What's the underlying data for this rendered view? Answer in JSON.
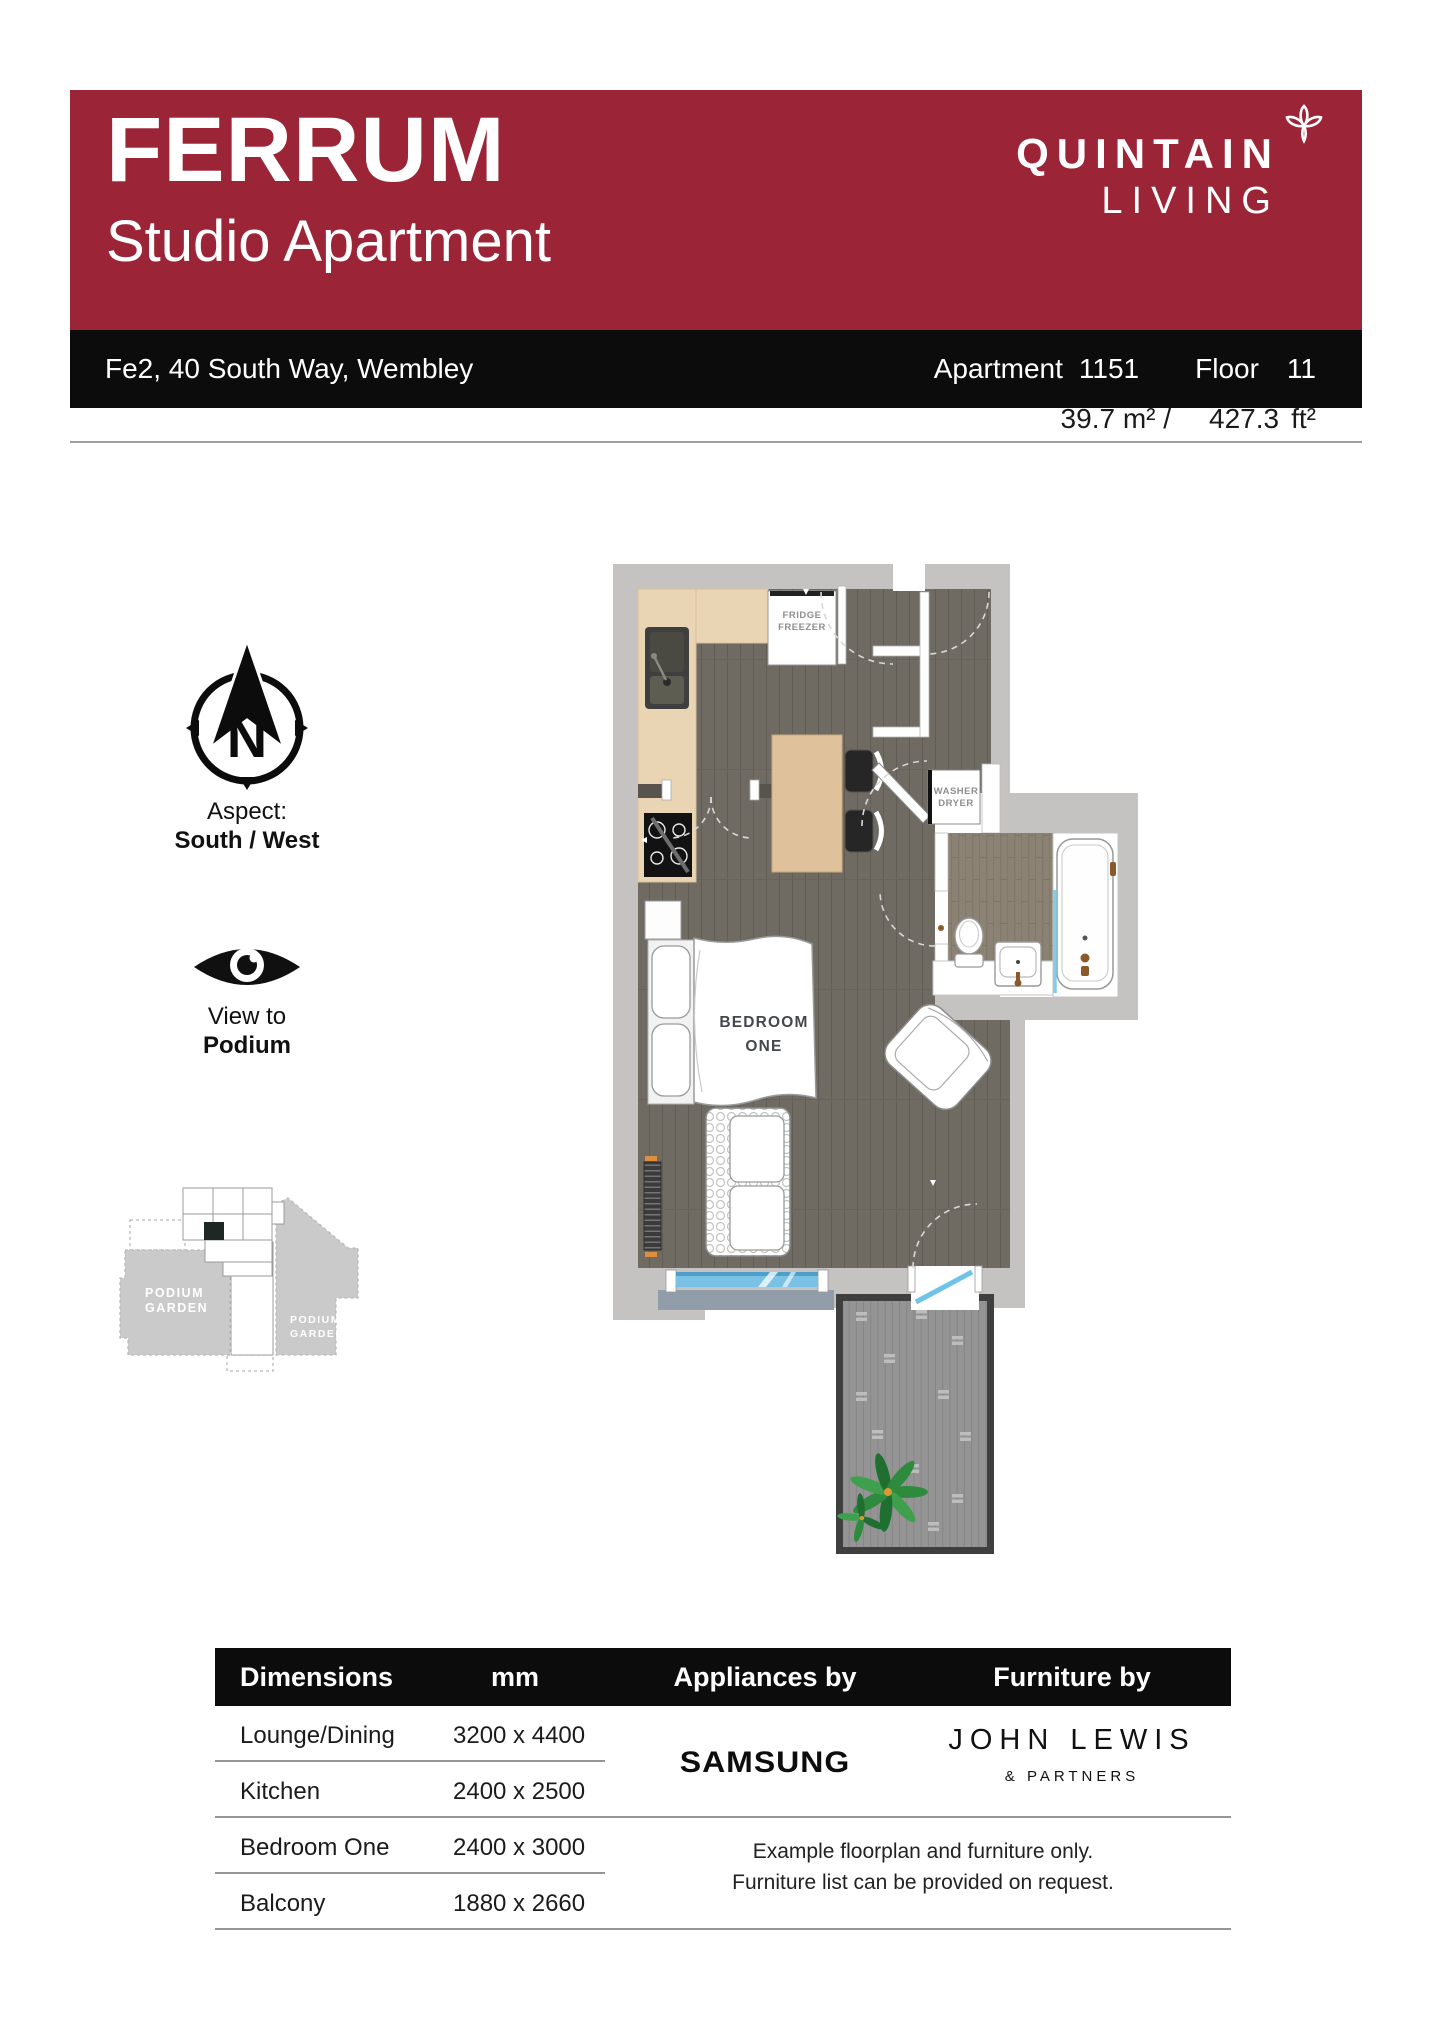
{
  "brand": {
    "banner_color": "#9c2437",
    "development": "FERRUM",
    "unit_type": "Studio Apartment",
    "logo_line1": "QUINTAIN",
    "logo_line2": "LIVING"
  },
  "info_bar": {
    "address": "Fe2, 40 South Way, Wembley",
    "apartment_label": "Apartment",
    "apartment_number": "1151",
    "floor_label": "Floor",
    "floor_number": "11"
  },
  "area": {
    "metric": "39.7 m² /",
    "imperial_value": "427.3",
    "imperial_unit": "ft²"
  },
  "aspect": {
    "label": "Aspect:",
    "value": "South / West",
    "compass_letter": "N"
  },
  "view": {
    "label": "View to",
    "value": "Podium"
  },
  "minimap": {
    "garden1_line1": "PODIUM",
    "garden1_line2": "GARDEN",
    "garden2_line1": "PODIUM",
    "garden2_line2": "GARDEN"
  },
  "floorplan": {
    "fridge_line1": "FRIDGE",
    "fridge_line2": "FREEZER",
    "washer_line1": "WASHER",
    "washer_line2": "DRYER",
    "bedroom_line1": "BEDROOM",
    "bedroom_line2": "ONE",
    "window_color": "#79c2e6"
  },
  "table": {
    "headers": [
      "Dimensions",
      "mm",
      "Appliances by",
      "Furniture by"
    ],
    "rows": [
      {
        "room": "Lounge/Dining",
        "size": "3200 x 4400"
      },
      {
        "room": "Kitchen",
        "size": "2400 x 2500"
      },
      {
        "room": "Bedroom One",
        "size": "2400 x 3000"
      },
      {
        "room": "Balcony",
        "size": "1880 x 2660"
      }
    ],
    "appliances_brand": "SAMSUNG",
    "furniture_brand_line1": "JOHN LEWIS",
    "furniture_brand_line2": "& PARTNERS",
    "disclaimer_line1": "Example floorplan and furniture only.",
    "disclaimer_line2": "Furniture list can be provided on request."
  }
}
